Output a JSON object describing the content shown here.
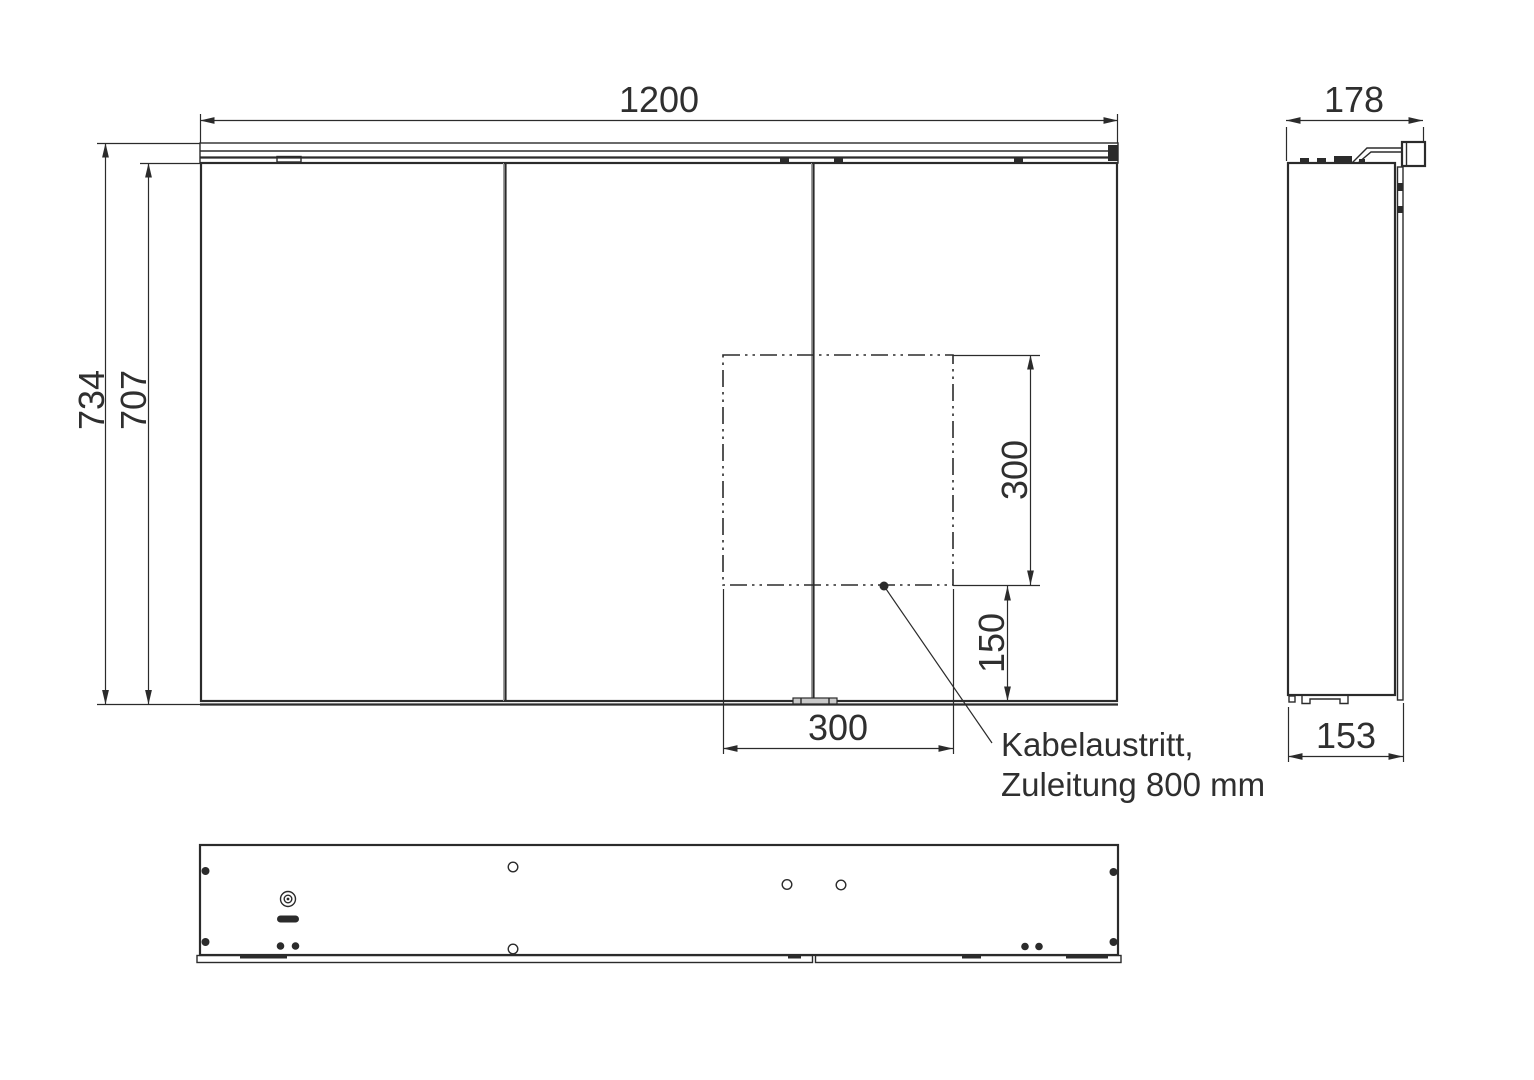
{
  "drawing": {
    "front_view": {
      "width": "1200",
      "total_height": "734",
      "carcass_height": "707",
      "cutout_square_height": "300",
      "cutout_bottom_offset": "150",
      "cutout_width": "300"
    },
    "side_view": {
      "total_depth": "178",
      "carcass_depth": "153"
    },
    "cable_note": {
      "line1": "Kabelaustritt,",
      "line2": "Zuleitung 800 mm"
    }
  }
}
